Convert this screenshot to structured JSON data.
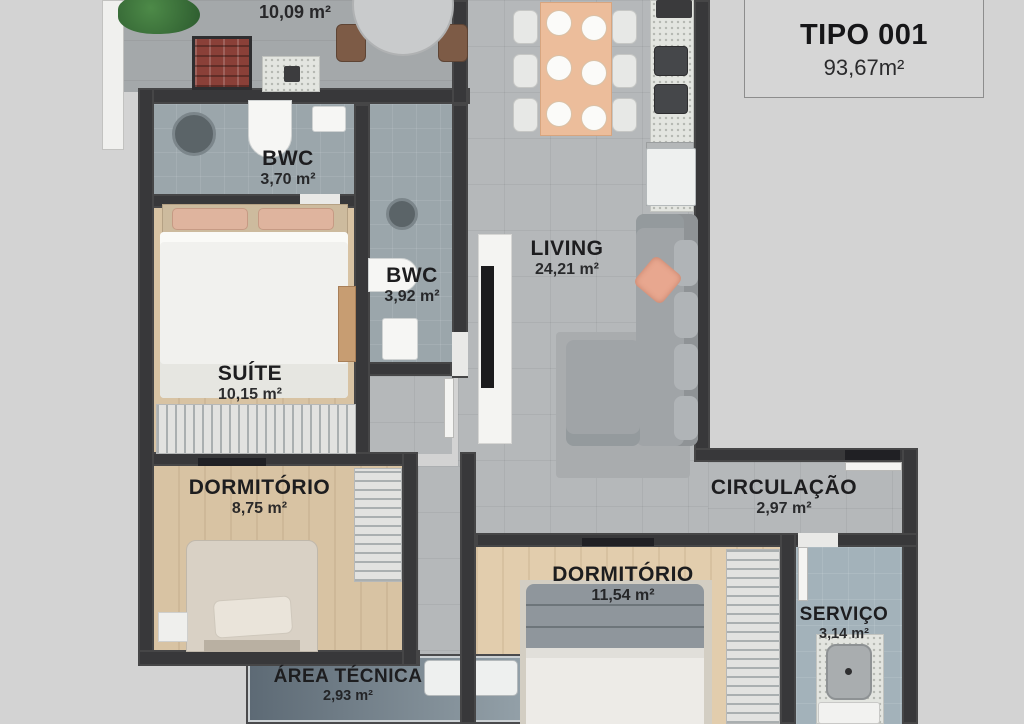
{
  "title_block": {
    "type_label": "TIPO 001",
    "total_area": "93,67m²"
  },
  "rooms": [
    {
      "id": "sacada",
      "name": "",
      "area": "10,09 m²"
    },
    {
      "id": "bwc-suite",
      "name": "BWC",
      "area": "3,70 m²"
    },
    {
      "id": "bwc-social",
      "name": "BWC",
      "area": "3,92 m²"
    },
    {
      "id": "living",
      "name": "LIVING",
      "area": "24,21 m²"
    },
    {
      "id": "suite",
      "name": "SUÍTE",
      "area": "10,15 m²"
    },
    {
      "id": "dormitorio-1",
      "name": "DORMITÓRIO",
      "area": "8,75 m²"
    },
    {
      "id": "circulacao",
      "name": "CIRCULAÇÃO",
      "area": "2,97 m²"
    },
    {
      "id": "dormitorio-2",
      "name": "DORMITÓRIO",
      "area": "11,54 m²"
    },
    {
      "id": "servico",
      "name": "SERVIÇO",
      "area": "3,14 m²"
    },
    {
      "id": "area-tecnica",
      "name": "ÁREA TÉCNICA",
      "area": "2,93 m²"
    }
  ],
  "colors": {
    "background": "#d3d3d3",
    "walls": "#38383a",
    "wood_floor": "#d8c3a3",
    "tile_floor": "#b5b8ba",
    "bath_floor": "#9ba6ab",
    "brick_bbq": "#8a4038",
    "accent_pillow": "#e8a78f",
    "text": "#1d1d1f"
  }
}
